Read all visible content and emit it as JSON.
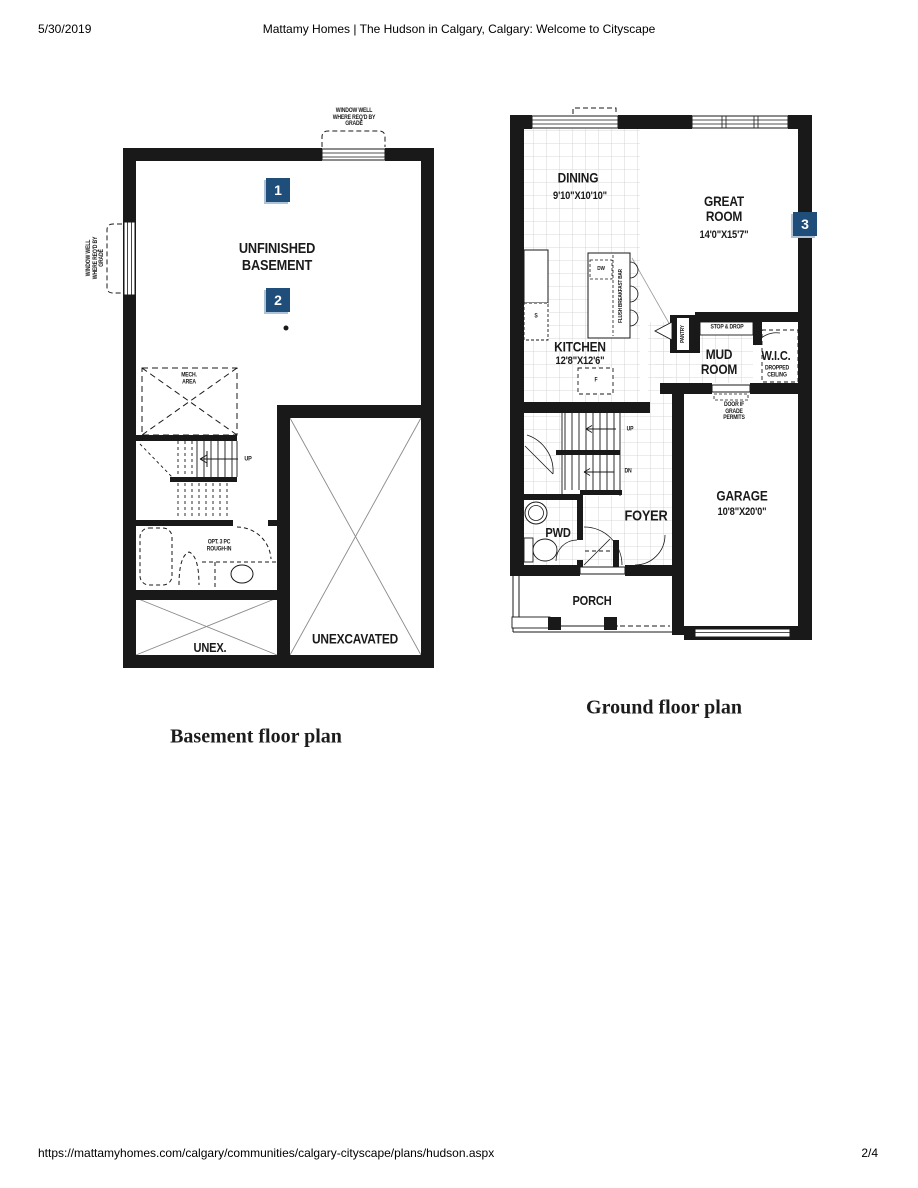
{
  "header": {
    "date": "5/30/2019",
    "title": "Mattamy Homes | The Hudson in Calgary, Calgary: Welcome to Cityscape"
  },
  "footer": {
    "url": "https://mattamyhomes.com/calgary/communities/calgary-cityscape/plans/hudson.aspx",
    "page": "2/4"
  },
  "colors": {
    "marker_bg": "#1E4E79",
    "marker_edge": "#AEC3D8"
  },
  "basement": {
    "caption": "Basement floor plan",
    "markers": {
      "one": "1",
      "two": "2"
    },
    "room": "UNFINISHED\nBASEMENT",
    "window_well_top": "WINDOW WELL\nWHERE REQ'D BY\nGRADE",
    "window_well_left": "WINDOW WELL\nWHERE REQ'D BY\nGRADE",
    "mech": "MECH.\nAREA",
    "up": "UP",
    "rough_in": "OPT. 3 PC\nROUGH-IN",
    "unex": "UNEX.",
    "unexcavated": "UNEXCAVATED"
  },
  "ground": {
    "caption": "Ground floor plan",
    "marker": "3",
    "dining": {
      "name": "DINING",
      "dim": "9'10\"X10'10\""
    },
    "great_room": {
      "name": "GREAT\nROOM",
      "dim": "14'0\"X15'7\""
    },
    "kitchen": {
      "name": "KITCHEN",
      "dim": "12'8\"X12'6\""
    },
    "garage": {
      "name": "GARAGE",
      "dim": "10'8\"X20'0\""
    },
    "mud_room": "MUD\nROOM",
    "wic": "W.I.C.",
    "dropped_ceiling": "DROPPED\nCEILING",
    "stop_drop": "STOP & DROP",
    "pantry": "PANTRY",
    "door_grade": "DOOR IF\nGRADE\nPERMITS",
    "foyer": "FOYER",
    "pwd": "PWD",
    "porch": "PORCH",
    "flush_bar": "FLUSH BREAKFAST BAR",
    "dw": "DW",
    "sink": "S",
    "fridge": "F",
    "up": "UP",
    "dn": "DN"
  }
}
